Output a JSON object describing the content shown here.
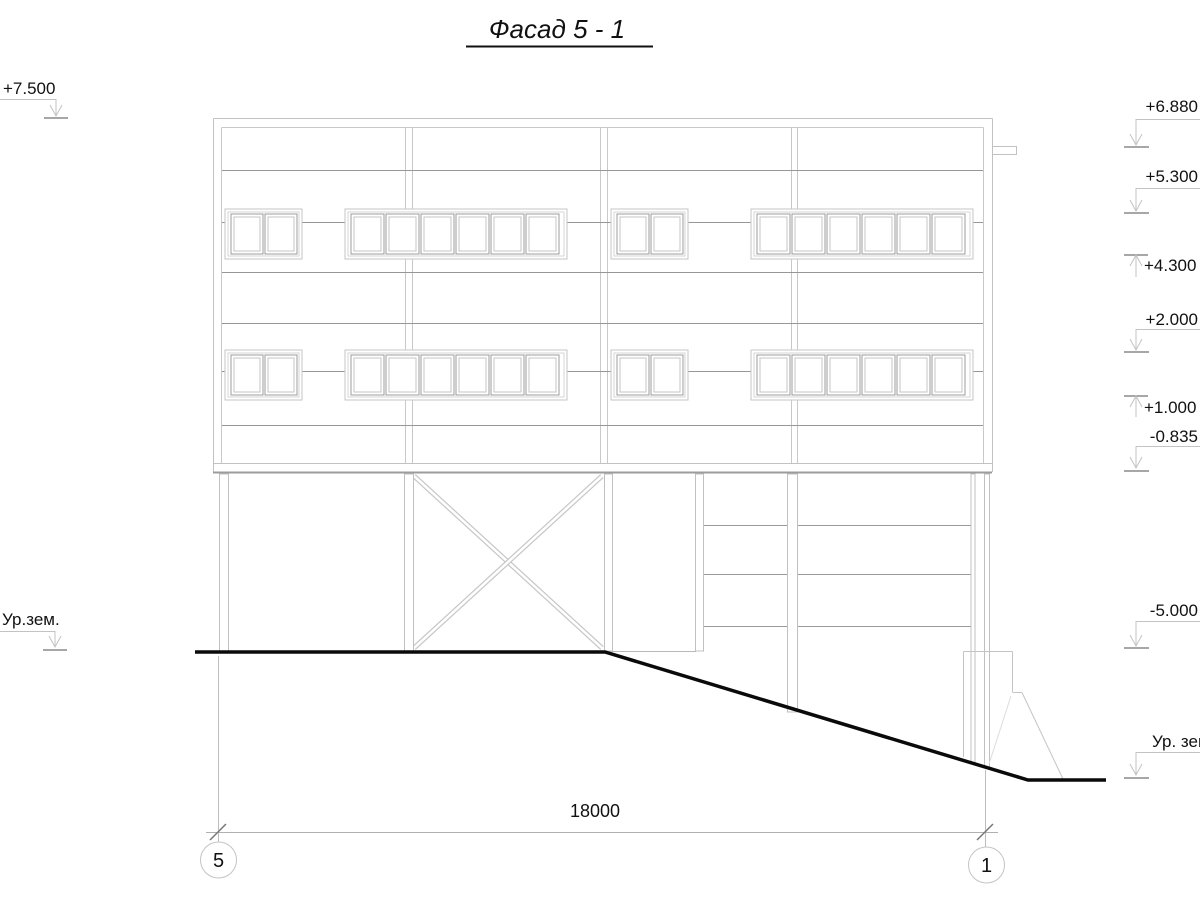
{
  "title": "Фасад 5 - 1",
  "elevation_marks": {
    "left": [
      {
        "label": "+7.500"
      },
      {
        "label": "Ур.зем."
      }
    ],
    "right": [
      {
        "label": "+6.880"
      },
      {
        "label": "+5.300"
      },
      {
        "label": "+4.300"
      },
      {
        "label": "+2.000"
      },
      {
        "label": "+1.000"
      },
      {
        "label": "-0.835"
      },
      {
        "label": "-5.000"
      },
      {
        "label": "Ур. зем."
      }
    ]
  },
  "dimension": {
    "length": "18000"
  },
  "axis_bubbles": [
    {
      "label": "5"
    },
    {
      "label": "1"
    }
  ],
  "colors": {
    "line_light": "#c9c9c9",
    "line_medium": "#979797",
    "ground_line": "#0a0a0a",
    "text": "#111111"
  }
}
